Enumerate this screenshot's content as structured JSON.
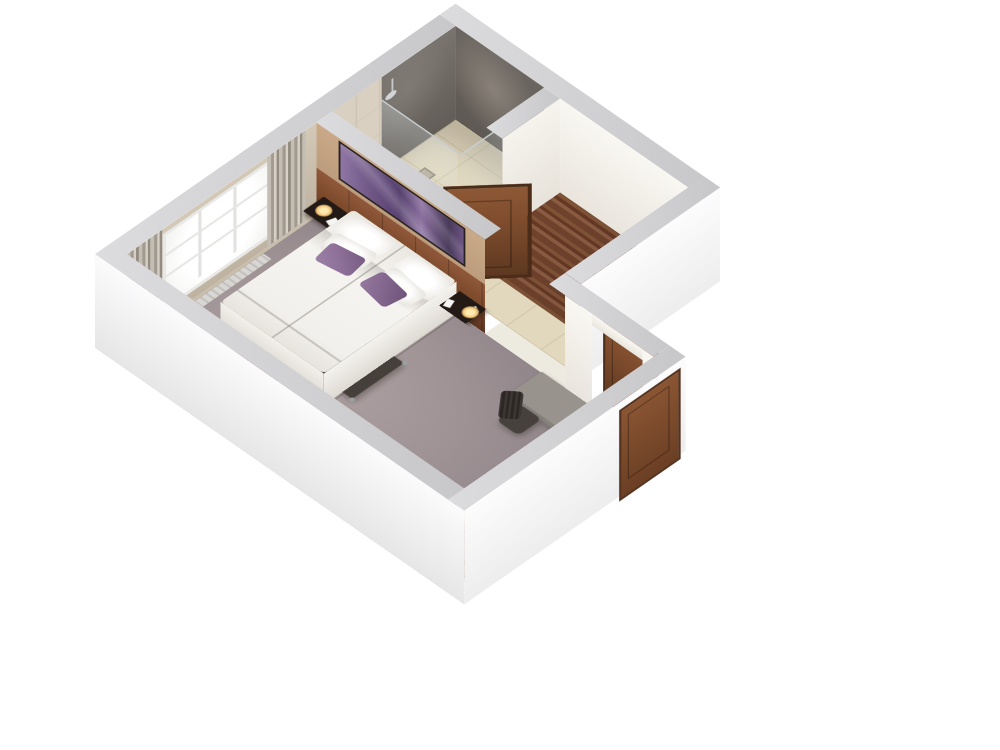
{
  "scene": {
    "title": "3D cutaway floor plan of a hotel guest room, isometric view",
    "type": "architectural-render",
    "background": "#ffffff"
  },
  "rooms": [
    {
      "name": "bedroom",
      "floor": "mauve carpet"
    },
    {
      "name": "bathroom",
      "floor": "beige tile",
      "walls": "slate gray and light tile"
    },
    {
      "name": "wardrobe-hall",
      "floor": "wood planks"
    },
    {
      "name": "entry-vestibule",
      "floor": "beige tile"
    }
  ],
  "furniture": [
    "double-bed",
    "white-duvet",
    "white-pillows",
    "purple-accent-cushions",
    "nightstand-window-side",
    "nightstand-door-side",
    "table-lamps",
    "wall-art-purple",
    "wood-headboard-panel",
    "window",
    "curtains",
    "radiator",
    "corner-sofa",
    "tufted-red-cushion",
    "coffee-table",
    "floor-lamp",
    "striped-wood-console",
    "console-knobs",
    "desk",
    "office-chair",
    "shower-enclosure-glass",
    "shower-head",
    "hand-shower",
    "floor-drain",
    "bathroom-door-open",
    "entrance-door"
  ],
  "palette": {
    "wall_outer": "#f6f6f7",
    "wall_top": "#c7c7c9",
    "wall_top_light": "#dcdcde",
    "carpet": "#9e9295",
    "tile": "#e2d8bd",
    "wood_floor": "#8a5638",
    "console_wood": "#9a512f",
    "wall_tan": "#c9a987",
    "headboard_wood": "#7d4a2c",
    "art_purple": "#6b5382",
    "bath_dark": "#6b6560",
    "bath_tile": "#d9d0c1",
    "bed_white": "#f2f0ec",
    "cushion_purple": "#8d6f97",
    "door_wood": "#7e4c2d",
    "sofa_gray": "#7e6f6c",
    "tufted_red": "#6d3138",
    "chrome": "#c8cdd0",
    "lamp_glow": "#ffeab0"
  }
}
